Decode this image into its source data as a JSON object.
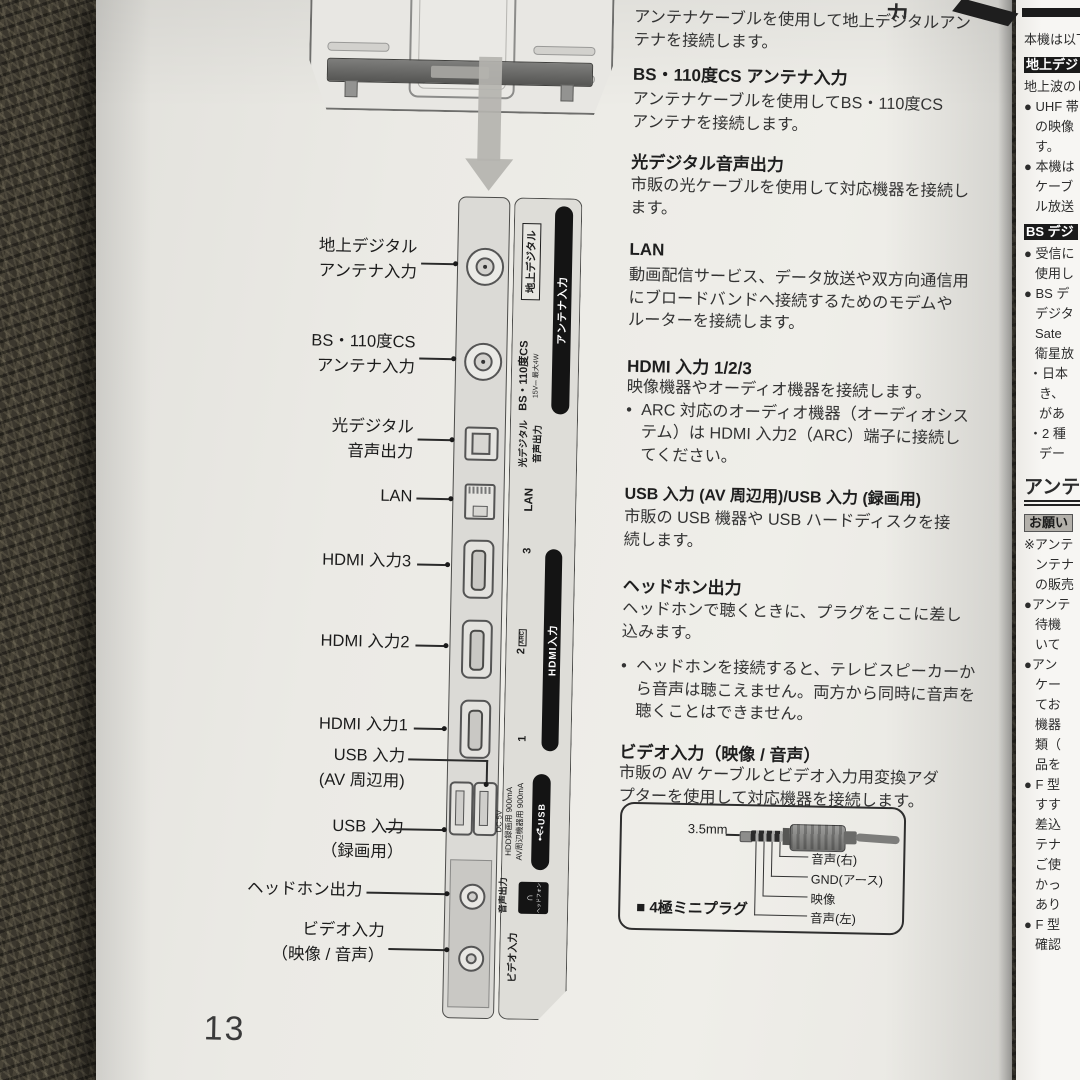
{
  "colors": {
    "page": "#ebeae5",
    "next_page": "#f7f6f3",
    "ink": "#2b2b2b",
    "label_bar": "#141414",
    "carpet": "#3b372e",
    "panel": "#dbdad6"
  },
  "icons": [
    "down-arrow-icon",
    "coax-connector-icon",
    "optical-connector-icon",
    "lan-connector-icon",
    "hdmi-connector-icon",
    "usb-connector-icon",
    "phone-jack-icon",
    "usb-trident-icon",
    "headphone-icon"
  ],
  "page_number": "13",
  "top_fragment": "力",
  "callouts": [
    {
      "l1": "地上デジタル",
      "l2": "アンテナ入力"
    },
    {
      "l1": "BS・110度CS",
      "l2": "アンテナ入力"
    },
    {
      "l1": "光デジタル",
      "l2": "音声出力"
    },
    {
      "l1": "LAN"
    },
    {
      "l1": "HDMI 入力3"
    },
    {
      "l1": "HDMI 入力2"
    },
    {
      "l1": "HDMI 入力1"
    },
    {
      "l1": "USB 入力",
      "l2": "(AV 周辺用)"
    },
    {
      "l1": "USB 入力",
      "l2": "（録画用）"
    },
    {
      "l1": "ヘッドホン出力"
    },
    {
      "l1": "ビデオ入力",
      "l2": "（映像 / 音声）"
    }
  ],
  "panel": {
    "terrestrial_tag": "地上デジタル",
    "antenna_bar": "アンテナ入力",
    "bs_main": "BS・110度CS",
    "bs_sub": "15V⎓ 最大4W",
    "optical_1": "光デジタル",
    "optical_2": "音声出力",
    "lan": "LAN",
    "hdmi_3": "3",
    "hdmi_2": "2",
    "hdmi_arc": "ARC",
    "hdmi_1": "1",
    "hdmi_bar": "HDMI入力",
    "dc": "DC 5V",
    "usb_line1": "HDD録画用 900mA",
    "usb_line2": "AV周辺機器用 900mA",
    "usb_bar": "USB",
    "audio_out": "音声出力",
    "headphone_icon_glyph": "∩",
    "headphone_chip": "ヘッドフォン",
    "video_in": "ビデオ入力"
  },
  "top_partial": {
    "b1": "アンテナケーブルを使用して地上デジタルアン",
    "b2": "テナを接続します。"
  },
  "sections": [
    {
      "heading": "BS・110度CS アンテナ入力",
      "b1": "アンテナケーブルを使用してBS・110度CS",
      "b2": "アンテナを接続します。"
    },
    {
      "heading": "光デジタル音声出力",
      "b1": "市販の光ケーブルを使用して対応機器を接続し",
      "b2": "ます。"
    },
    {
      "heading": "LAN",
      "b1": "動画配信サービス、データ放送や双方向通信用",
      "b2": "にブロードバンドへ接続するためのモデムや",
      "b3": "ルーターを接続します。"
    },
    {
      "heading": "HDMI 入力 1/2/3",
      "b1": "映像機器やオーディオ機器を接続します。",
      "bullet1": "ARC 対応のオーディオ機器（オーディオシス",
      "bullet2": "テム）は HDMI 入力2（ARC）端子に接続し",
      "bullet3": "てください。"
    },
    {
      "heading": "USB 入力 (AV 周辺用)/USB 入力 (録画用)",
      "b1": "市販の USB 機器や USB ハードディスクを接",
      "b2": "続します。"
    },
    {
      "heading": "ヘッドホン出力",
      "b1": "ヘッドホンで聴くときに、プラグをここに差し",
      "b2": "込みます。",
      "bullet1": "ヘッドホンを接続すると、テレビスピーカーか",
      "bullet2": "ら音声は聴こえません。両方から同時に音声を",
      "bullet3": "聴くことはできません。"
    },
    {
      "heading": "ビデオ入力（映像 / 音声）",
      "b1": "市販の AV ケーブルとビデオ入力用変換アダ",
      "b2": "プターを使用して対応機器を接続します。"
    }
  ],
  "bullet_marker": "•",
  "plug_box": {
    "size": "3.5mm",
    "pin1": "音声(右)",
    "pin2": "GND(アース)",
    "pin3": "映像",
    "pin4": "音声(左)",
    "caption_marker": "■",
    "caption": "4極ミニプラグ"
  },
  "right_page": {
    "l01": "本機は以下",
    "l02": "地上デジ",
    "l03": "地上波のし",
    "l04": "● UHF 帯",
    "l05": "の映像",
    "l06": "す。",
    "l07": "● 本機は",
    "l08": "ケーブ",
    "l09": "ル放送",
    "l10": "BS デジ",
    "l11": "● 受信に",
    "l12": "使用し",
    "l13": "● BS デ",
    "l14": "デジタ",
    "l15": "Sate",
    "l16": "衛星放",
    "l17": "・日本",
    "l18": "き、",
    "l19": "があ",
    "l20": "・2 種",
    "l21": "デー",
    "l22": "アンテ",
    "l23": "お願い",
    "l24": "※アンテ",
    "l25": "ンテナ",
    "l26": "の販売",
    "l27": "●アンテ",
    "l28": "待機",
    "l29": "いて",
    "l30": "●アン",
    "l31": "ケー",
    "l32": "てお",
    "l33": "機器",
    "l34": "類（",
    "l35": "品を",
    "l36": "● F 型",
    "l37": "すす",
    "l38": "差込",
    "l39": "テナ",
    "l40": "ご使",
    "l41": "かっ",
    "l42": "あり",
    "l43": "● F 型",
    "l44": "確認"
  }
}
